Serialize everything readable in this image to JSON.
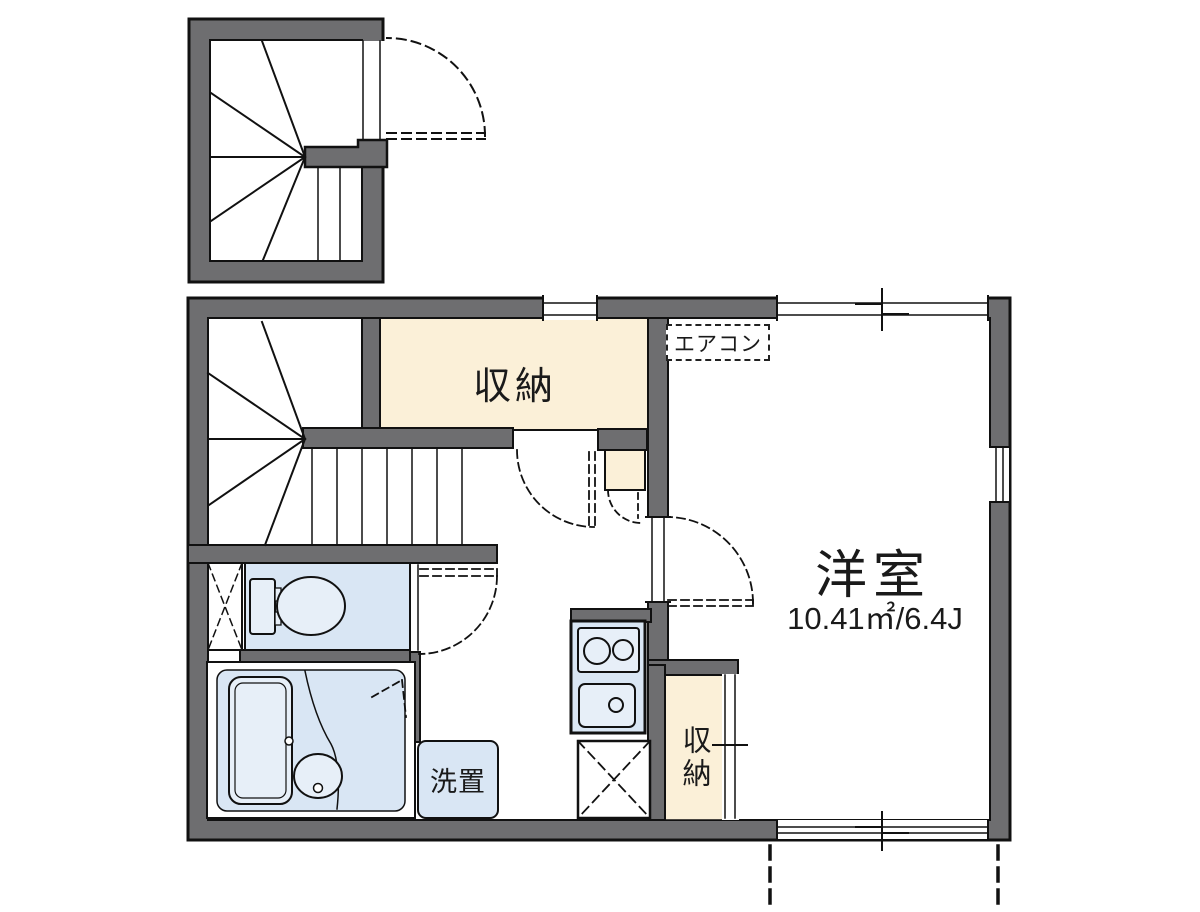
{
  "title": "apartment-floor-plan",
  "colors": {
    "wall": "#6e6e70",
    "outline": "#111111",
    "cream": "#fbf0d8",
    "blue": "#d9e6f4",
    "blue_light": "#e7eff8",
    "white": "#ffffff"
  },
  "labels": {
    "upper_storage": "収納",
    "aircon": "エアコン",
    "room_name": "洋室",
    "room_area": "10.41㎡/6.4J",
    "laundry": "洗置",
    "lower_storage": "収納"
  },
  "rooms": {
    "western_room": {
      "name": "洋室",
      "area_sqm": "10.41㎡",
      "area_tatami": "6.4J"
    },
    "storage_top": {
      "name": "収納"
    },
    "storage_bottom": {
      "name": "収納"
    },
    "laundry_space": {
      "name": "洗置"
    },
    "aircon_slot": {
      "name": "エアコン"
    }
  }
}
